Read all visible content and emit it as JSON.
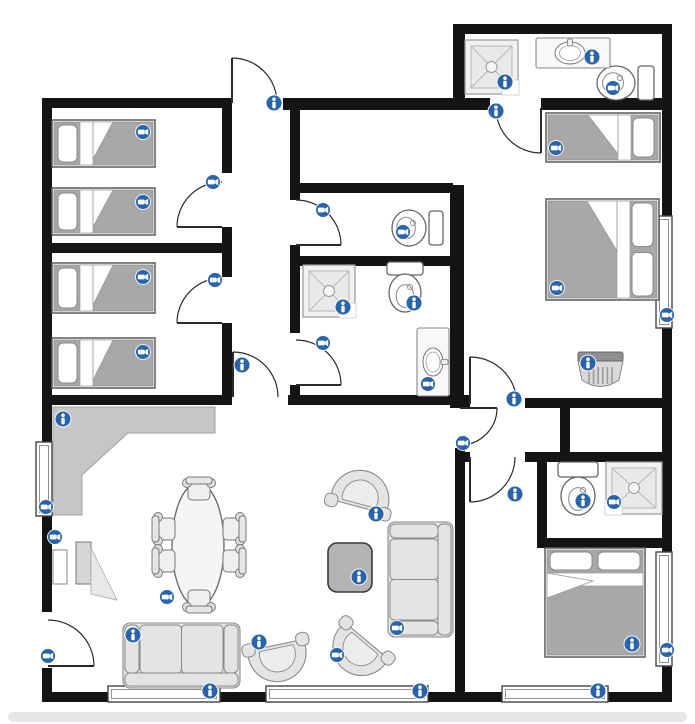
{
  "canvas": {
    "width": 695,
    "height": 724,
    "background": "#ffffff"
  },
  "palette": {
    "wall": "#141414",
    "window_stroke": "#444444",
    "window_inner": "#777777",
    "door_stroke": "#2a2a2a",
    "furn_stroke": "#8a8a8a",
    "furn_fill": "#e4e4e4",
    "bed_stroke": "#5a5a5a",
    "mattress": "#a8a8a8",
    "pillow": "#ffffff",
    "counter": "#c6c6c6",
    "coffee_table": "#b3b3b3",
    "marker_blue": "#2a64a8",
    "marker_glyph": "#ffffff",
    "scrollbar": "#e4e6e8"
  },
  "walls": [
    [
      42,
      98,
      190,
      10
    ],
    [
      283,
      98,
      207,
      12
    ],
    [
      541,
      98,
      131,
      12
    ],
    [
      453,
      24,
      219,
      10
    ],
    [
      453,
      24,
      12,
      86
    ],
    [
      662,
      24,
      10,
      678
    ],
    [
      42,
      98,
      10,
      514
    ],
    [
      42,
      668,
      10,
      34
    ],
    [
      42,
      692,
      630,
      10
    ],
    [
      42,
      243,
      190,
      10
    ],
    [
      222,
      108,
      10,
      65
    ],
    [
      222,
      227,
      10,
      50
    ],
    [
      222,
      323,
      10,
      77
    ],
    [
      42,
      395,
      190,
      10
    ],
    [
      288,
      395,
      172,
      10
    ],
    [
      290,
      110,
      10,
      90
    ],
    [
      290,
      245,
      10,
      88
    ],
    [
      290,
      385,
      10,
      20
    ],
    [
      300,
      183,
      153,
      10
    ],
    [
      290,
      256,
      163,
      10
    ],
    [
      450,
      185,
      14,
      210
    ],
    [
      450,
      395,
      20,
      13
    ],
    [
      525,
      398,
      137,
      10
    ],
    [
      560,
      408,
      10,
      45
    ],
    [
      455,
      452,
      15,
      10
    ],
    [
      525,
      452,
      147,
      10
    ],
    [
      455,
      448,
      10,
      244
    ],
    [
      537,
      462,
      10,
      78
    ],
    [
      537,
      538,
      125,
      10
    ]
  ],
  "windows": [
    {
      "x": 108,
      "y": 686,
      "w": 112,
      "h": 16
    },
    {
      "x": 266,
      "y": 686,
      "w": 162,
      "h": 16
    },
    {
      "x": 502,
      "y": 686,
      "w": 106,
      "h": 16
    },
    {
      "x": 656,
      "y": 216,
      "w": 16,
      "h": 112
    },
    {
      "x": 656,
      "y": 552,
      "w": 16,
      "h": 114
    },
    {
      "x": 36,
      "y": 442,
      "w": 16,
      "h": 74
    }
  ],
  "doors": [
    {
      "hx": 232,
      "hy": 103,
      "lx": 232,
      "ly": 58,
      "rot": 1
    },
    {
      "hx": 222,
      "hy": 227,
      "lx": 177,
      "ly": 227,
      "rot": 1
    },
    {
      "hx": 222,
      "hy": 323,
      "lx": 177,
      "ly": 323,
      "rot": 1
    },
    {
      "hx": 296,
      "hy": 245,
      "lx": 341,
      "ly": 245,
      "rot": -1
    },
    {
      "hx": 296,
      "hy": 385,
      "lx": 341,
      "ly": 385,
      "rot": -1
    },
    {
      "hx": 233,
      "hy": 397,
      "lx": 233,
      "ly": 352,
      "rot": 1
    },
    {
      "hx": 541,
      "hy": 108,
      "lx": 541,
      "ly": 153,
      "rot": 1
    },
    {
      "hx": 470,
      "hy": 404,
      "lx": 470,
      "ly": 357,
      "rot": 1
    },
    {
      "hx": 460,
      "hy": 408,
      "lx": 497,
      "ly": 408,
      "rot": 1
    },
    {
      "hx": 470,
      "hy": 457,
      "lx": 470,
      "ly": 502,
      "rot": -1
    },
    {
      "hx": 48,
      "hy": 666,
      "lx": 94,
      "ly": 666,
      "rot": -1
    }
  ],
  "furniture": [
    {
      "type": "counter",
      "points": [
        [
          53,
          407
        ],
        [
          215,
          407
        ],
        [
          215,
          433
        ],
        [
          128,
          433
        ],
        [
          82,
          475
        ],
        [
          82,
          515
        ],
        [
          53,
          515
        ]
      ]
    },
    {
      "type": "tv",
      "x": 53,
      "y": 542
    },
    {
      "type": "bed",
      "x": 52,
      "y": 120,
      "w": 103,
      "h": 47,
      "head": "left",
      "pillows": 1
    },
    {
      "type": "bed",
      "x": 52,
      "y": 188,
      "w": 103,
      "h": 47,
      "head": "left",
      "pillows": 1
    },
    {
      "type": "bed",
      "x": 52,
      "y": 263,
      "w": 103,
      "h": 50,
      "head": "left",
      "pillows": 1
    },
    {
      "type": "bed",
      "x": 52,
      "y": 338,
      "w": 103,
      "h": 50,
      "head": "left",
      "pillows": 1
    },
    {
      "type": "bed",
      "x": 546,
      "y": 113,
      "w": 114,
      "h": 49,
      "head": "right",
      "pillows": 1
    },
    {
      "type": "bed",
      "x": 546,
      "y": 199,
      "w": 113,
      "h": 101,
      "head": "right",
      "pillows": 2
    },
    {
      "type": "bed",
      "x": 545,
      "y": 548,
      "w": 100,
      "h": 109,
      "head": "top",
      "pillows": 2
    },
    {
      "type": "toilet",
      "tank": [
        638,
        66,
        16,
        34
      ],
      "bowl": [
        616,
        83,
        19,
        17
      ],
      "facing": "left"
    },
    {
      "type": "toilet",
      "tank": [
        429,
        211,
        14,
        34
      ],
      "bowl": [
        409,
        228,
        17,
        18
      ],
      "facing": "left"
    },
    {
      "type": "toilet",
      "tank": [
        387,
        262,
        36,
        13
      ],
      "bowl": [
        405,
        293,
        16,
        19
      ],
      "facing": "down"
    },
    {
      "type": "toilet",
      "tank": [
        558,
        462,
        40,
        15
      ],
      "bowl": [
        578,
        496,
        17,
        19
      ],
      "facing": "down"
    },
    {
      "type": "shower",
      "x": 465,
      "y": 40,
      "w": 53,
      "h": 54,
      "notch": "br"
    },
    {
      "type": "shower",
      "x": 303,
      "y": 265,
      "w": 52,
      "h": 52,
      "notch": "br"
    },
    {
      "type": "shower",
      "x": 606,
      "y": 462,
      "w": 56,
      "h": 52,
      "notch": "bl"
    },
    {
      "type": "vanity",
      "x": 536,
      "y": 38,
      "w": 74,
      "h": 30,
      "orient": "h"
    },
    {
      "type": "vanity",
      "x": 417,
      "y": 328,
      "w": 32,
      "h": 68,
      "orient": "v"
    },
    {
      "type": "appliance",
      "x": 578,
      "y": 352,
      "w": 45,
      "h": 41
    },
    {
      "type": "dining-table",
      "cx": 198,
      "cy": 545,
      "rx": 26,
      "ry": 62
    },
    {
      "type": "chair",
      "cx": 199,
      "cy": 490,
      "rot": 0
    },
    {
      "type": "chair",
      "cx": 199,
      "cy": 600,
      "rot": 180
    },
    {
      "type": "chair",
      "cx": 165,
      "cy": 529,
      "rot": 270
    },
    {
      "type": "chair",
      "cx": 165,
      "cy": 561,
      "rot": 270
    },
    {
      "type": "chair",
      "cx": 233,
      "cy": 529,
      "rot": 90
    },
    {
      "type": "chair",
      "cx": 233,
      "cy": 561,
      "rot": 90
    },
    {
      "type": "sofa",
      "x": 123,
      "y": 623,
      "w": 117,
      "h": 65,
      "back": "bottom"
    },
    {
      "type": "sofa",
      "x": 388,
      "y": 522,
      "w": 65,
      "h": 115,
      "back": "right"
    },
    {
      "type": "barrel-chair",
      "cx": 278,
      "cy": 657,
      "r": 29,
      "rot": -12
    },
    {
      "type": "barrel-chair",
      "cx": 361,
      "cy": 495,
      "r": 30,
      "rot": 195
    },
    {
      "type": "barrel-chair",
      "cx": 359,
      "cy": 650,
      "r": 30,
      "rot": 40
    },
    {
      "type": "coffee-table",
      "x": 328,
      "y": 543,
      "w": 44,
      "h": 49
    }
  ],
  "markers": [
    {
      "kind": "info",
      "x": 274,
      "y": 103
    },
    {
      "kind": "cam",
      "x": 143,
      "y": 132
    },
    {
      "kind": "cam",
      "x": 143,
      "y": 202
    },
    {
      "kind": "cam",
      "x": 143,
      "y": 277
    },
    {
      "kind": "cam",
      "x": 143,
      "y": 352
    },
    {
      "kind": "cam",
      "x": 213,
      "y": 182
    },
    {
      "kind": "cam",
      "x": 215,
      "y": 280
    },
    {
      "kind": "info",
      "x": 242,
      "y": 365
    },
    {
      "kind": "cam",
      "x": 323,
      "y": 210
    },
    {
      "kind": "cam",
      "x": 403,
      "y": 232
    },
    {
      "kind": "info",
      "x": 343,
      "y": 307
    },
    {
      "kind": "info",
      "x": 414,
      "y": 303
    },
    {
      "kind": "cam",
      "x": 428,
      "y": 384
    },
    {
      "kind": "cam",
      "x": 323,
      "y": 343
    },
    {
      "kind": "info",
      "x": 496,
      "y": 111
    },
    {
      "kind": "info",
      "x": 505,
      "y": 82
    },
    {
      "kind": "info",
      "x": 592,
      "y": 57
    },
    {
      "kind": "cam",
      "x": 613,
      "y": 88
    },
    {
      "kind": "cam",
      "x": 556,
      "y": 148
    },
    {
      "kind": "cam",
      "x": 557,
      "y": 288
    },
    {
      "kind": "cam",
      "x": 667,
      "y": 315
    },
    {
      "kind": "info",
      "x": 588,
      "y": 363
    },
    {
      "kind": "info",
      "x": 514,
      "y": 399
    },
    {
      "kind": "cam",
      "x": 463,
      "y": 443
    },
    {
      "kind": "info",
      "x": 515,
      "y": 494
    },
    {
      "kind": "info",
      "x": 583,
      "y": 501
    },
    {
      "kind": "cam",
      "x": 614,
      "y": 502
    },
    {
      "kind": "info",
      "x": 632,
      "y": 644
    },
    {
      "kind": "cam",
      "x": 667,
      "y": 650
    },
    {
      "kind": "info",
      "x": 598,
      "y": 691
    },
    {
      "kind": "info",
      "x": 420,
      "y": 691
    },
    {
      "kind": "info",
      "x": 210,
      "y": 691
    },
    {
      "kind": "cam",
      "x": 46,
      "y": 507
    },
    {
      "kind": "cam",
      "x": 55,
      "y": 537
    },
    {
      "kind": "info",
      "x": 63,
      "y": 419
    },
    {
      "kind": "cam",
      "x": 167,
      "y": 597
    },
    {
      "kind": "info",
      "x": 133,
      "y": 635
    },
    {
      "kind": "info",
      "x": 259,
      "y": 642
    },
    {
      "kind": "info",
      "x": 376,
      "y": 514
    },
    {
      "kind": "info",
      "x": 359,
      "y": 577
    },
    {
      "kind": "cam",
      "x": 397,
      "y": 628
    },
    {
      "kind": "cam",
      "x": 337,
      "y": 655
    },
    {
      "kind": "cam",
      "x": 48,
      "y": 656
    }
  ],
  "scrollbar": {
    "x": 8,
    "y": 712,
    "w": 679,
    "h": 10,
    "r": 5
  }
}
